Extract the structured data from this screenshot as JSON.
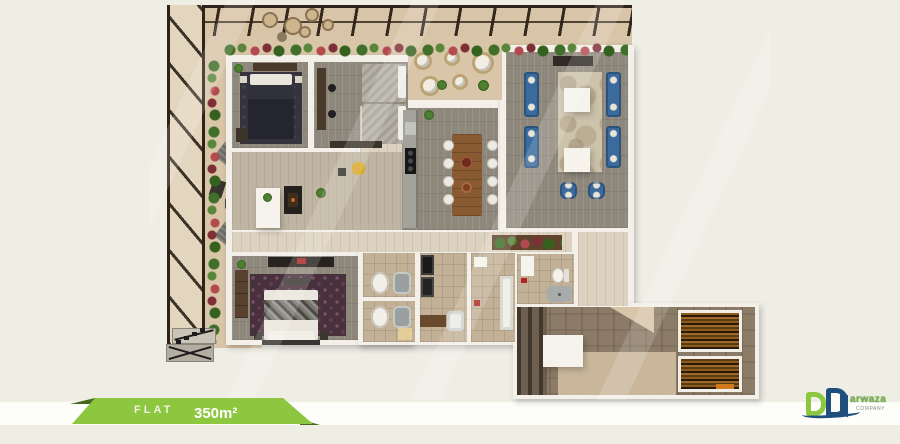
{
  "banner": {
    "label": "FLAT",
    "area": "350m²"
  },
  "logo": {
    "initial": "D",
    "name": "arwaza",
    "company": "COMPANY",
    "brand": "Darwaza"
  },
  "colors": {
    "background": "#efeee5",
    "stripe": "#fdfdfa",
    "ribbon_green": "#8dc63f",
    "ribbon_dark_green": "#45671c",
    "logo_green": "#8dc63f",
    "logo_blue": "#1f4f7c",
    "terrace_tan": "#d9c5a8",
    "wall_white": "#f3f0e9",
    "sofa_blue": "#3a6b9c",
    "dining_wood": "#8a5a33",
    "master_rug": "#49303d",
    "lobby_carpet": "#8b7b67",
    "elevator_wood": "#8d5d20"
  },
  "plan": {
    "type": "apartment-floor-plan-render",
    "area_label": "350m²",
    "rooms": [
      "pergola-terrace",
      "bedroom-1",
      "bedroom-2",
      "balcony-lounge",
      "formal-living-room",
      "kitchen",
      "dining-area",
      "family-lounge",
      "corridor",
      "master-bedroom",
      "bathroom-1",
      "bathroom-2",
      "laundry",
      "bathroom-3",
      "wc",
      "hallway",
      "entrance-lobby",
      "stairs",
      "elevators"
    ]
  }
}
